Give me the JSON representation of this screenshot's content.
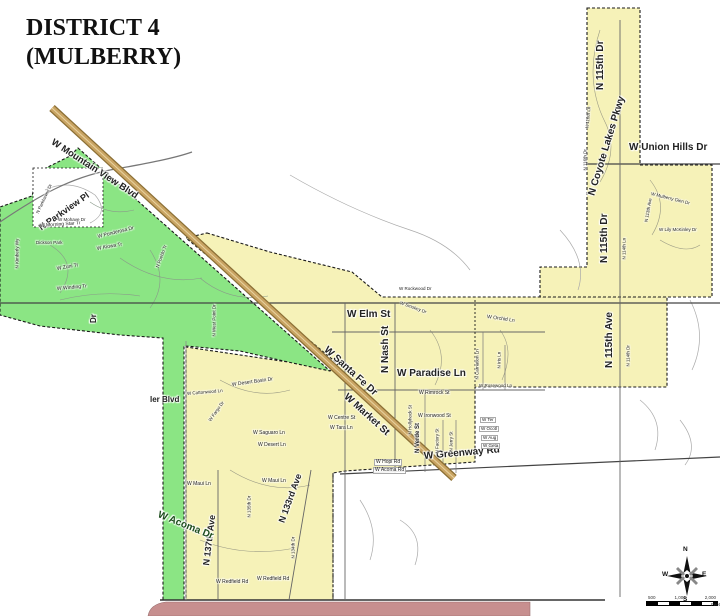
{
  "title": {
    "line1": "DISTRICT 4",
    "line2": "(MULBERRY)"
  },
  "colors": {
    "district_fill": "#F6F2B8",
    "district_green": "#8BE584",
    "adjacent_district_pink": "#C78F8F",
    "highway_tan": "#C9A463",
    "highway_edge": "#8B6F35",
    "boundary": "#1a1a1a",
    "road_gray": "#777777"
  },
  "compass": {
    "n": "N",
    "e": "E",
    "s": "S",
    "w": "W"
  },
  "scale": {
    "t1": "500",
    "t2": "1,000",
    "t3": "2,000",
    "unit": "Feet"
  },
  "labels": [
    {
      "t": "W Mountain View Blvd",
      "x": 52,
      "y": 146,
      "r": 33,
      "s": 9.5,
      "b": 1
    },
    {
      "t": "N Parkview Pl",
      "x": 40,
      "y": 233,
      "r": -35,
      "s": 9,
      "b": 1
    },
    {
      "t": "W Morning Star Tr",
      "x": 40,
      "y": 229,
      "r": -4,
      "s": 5
    },
    {
      "t": "Dickson Park",
      "x": 36,
      "y": 245,
      "s": 4.5
    },
    {
      "t": "W Ponderosa Dr",
      "x": 98,
      "y": 240,
      "r": -14,
      "s": 5
    },
    {
      "t": "W Kiowa Tr",
      "x": 97,
      "y": 252,
      "r": -10,
      "s": 5
    },
    {
      "t": "W Zuni Tr",
      "x": 57,
      "y": 272,
      "r": -10,
      "s": 5
    },
    {
      "t": "W Winding Tr",
      "x": 57,
      "y": 292,
      "r": -5,
      "s": 5
    },
    {
      "t": "N Kimberly Wy",
      "x": 20,
      "y": 268,
      "r": -90,
      "s": 4.5,
      "v": 1
    },
    {
      "t": "N Pueblo Tr",
      "x": 160,
      "y": 268,
      "r": -70,
      "s": 4.5,
      "v": 1
    },
    {
      "t": "W Mohave Dr",
      "x": 58,
      "y": 222,
      "s": 4.5
    },
    {
      "t": "N Parkhaven Dr",
      "x": 40,
      "y": 214,
      "r": -65,
      "s": 4.5,
      "v": 1
    },
    {
      "t": "Dr",
      "x": 98,
      "y": 323,
      "r": -90,
      "s": 8,
      "b": 1,
      "v": 1
    },
    {
      "t": "N West Point Dr",
      "x": 217,
      "y": 336,
      "r": -90,
      "s": 4.5,
      "v": 1
    },
    {
      "t": "ler Blvd",
      "x": 150,
      "y": 404,
      "s": 8,
      "b": 1
    },
    {
      "t": "W Santa Fe Dr",
      "x": 325,
      "y": 354,
      "r": 42,
      "s": 10,
      "b": 1
    },
    {
      "t": "W Market St",
      "x": 345,
      "y": 401,
      "r": 42,
      "s": 10,
      "b": 1
    },
    {
      "t": "W Elm St",
      "x": 347,
      "y": 320,
      "s": 10,
      "b": 1
    },
    {
      "t": "N Nash St",
      "x": 391,
      "y": 373,
      "r": -90,
      "s": 10,
      "b": 1,
      "v": 1
    },
    {
      "t": "W Paradise Ln",
      "x": 397,
      "y": 379,
      "s": 10,
      "b": 1
    },
    {
      "t": "W Greenway Rd",
      "x": 424,
      "y": 462,
      "r": -5,
      "s": 10,
      "b": 1
    },
    {
      "t": "W Union Hills Dr",
      "x": 629,
      "y": 153,
      "s": 10,
      "b": 1
    },
    {
      "t": "N 115th Dr",
      "x": 606,
      "y": 90,
      "r": -90,
      "s": 10,
      "b": 1,
      "v": 1
    },
    {
      "t": "N Coyote Lakes Pkwy",
      "x": 597,
      "y": 197,
      "r": -73,
      "s": 10,
      "b": 1,
      "v": 1
    },
    {
      "t": "N 115th Dr",
      "x": 610,
      "y": 263,
      "r": -90,
      "s": 10,
      "b": 1,
      "v": 1
    },
    {
      "t": "N 115th Ave",
      "x": 615,
      "y": 368,
      "r": -90,
      "s": 10,
      "b": 1,
      "v": 1
    },
    {
      "t": "N 137th Ave",
      "x": 211,
      "y": 566,
      "r": -83,
      "s": 9,
      "b": 1,
      "v": 1
    },
    {
      "t": "N 133rd Ave",
      "x": 286,
      "y": 524,
      "r": -70,
      "s": 9,
      "b": 1,
      "v": 1
    },
    {
      "t": "W Acoma Dr",
      "x": 158,
      "y": 520,
      "r": 22,
      "s": 10,
      "b": 1,
      "c": "#1d4d1d"
    },
    {
      "t": "W Rockwood Dr",
      "x": 399,
      "y": 291,
      "s": 4.5
    },
    {
      "t": "W Smokey Dr",
      "x": 400,
      "y": 305,
      "r": 20,
      "s": 4.5
    },
    {
      "t": "W Rimrock St",
      "x": 419,
      "y": 396,
      "s": 5
    },
    {
      "t": "W Ironwood St",
      "x": 418,
      "y": 419,
      "s": 5
    },
    {
      "t": "N Hollyhock St",
      "x": 413,
      "y": 434,
      "r": -90,
      "s": 4.5,
      "v": 1
    },
    {
      "t": "N Verde St",
      "x": 421,
      "y": 453,
      "r": -90,
      "s": 6,
      "b": 1,
      "v": 1
    },
    {
      "t": "N Factory St",
      "x": 440,
      "y": 453,
      "r": -90,
      "s": 4.5,
      "v": 1
    },
    {
      "t": "N Jerry St",
      "x": 454,
      "y": 451,
      "r": -90,
      "s": 4.5,
      "v": 1
    },
    {
      "t": "W Centre St",
      "x": 328,
      "y": 421,
      "s": 5
    },
    {
      "t": "W Tara Ln",
      "x": 330,
      "y": 431,
      "s": 5
    },
    {
      "t": "W Saguaro Ln",
      "x": 253,
      "y": 436,
      "s": 5
    },
    {
      "t": "W Desert Ln",
      "x": 258,
      "y": 448,
      "s": 5
    },
    {
      "t": "W Desert Basin Dr",
      "x": 232,
      "y": 388,
      "r": -8,
      "s": 5
    },
    {
      "t": "W Fargo Dr",
      "x": 212,
      "y": 422,
      "r": -55,
      "s": 4.5,
      "v": 1
    },
    {
      "t": "W Cottonwood Ln",
      "x": 187,
      "y": 396,
      "r": -5,
      "s": 4.5
    },
    {
      "t": "W Orchid Ln",
      "x": 487,
      "y": 320,
      "r": 8,
      "s": 5
    },
    {
      "t": "N Carnation Ln",
      "x": 480,
      "y": 379,
      "r": -90,
      "s": 4.5,
      "v": 1
    },
    {
      "t": "N Iris Ln",
      "x": 502,
      "y": 368,
      "r": -90,
      "s": 4.5,
      "v": 1
    },
    {
      "t": "W Rosewood Ln",
      "x": 479,
      "y": 388,
      "s": 4.5
    },
    {
      "t": "W Hopi Rd",
      "x": 374,
      "y": 464,
      "s": 5,
      "box": 1
    },
    {
      "t": "W Acoma Rd",
      "x": 373,
      "y": 472,
      "s": 5,
      "box": 1
    },
    {
      "t": "W Maui Ln",
      "x": 187,
      "y": 487,
      "s": 5
    },
    {
      "t": "W Maui Ln",
      "x": 262,
      "y": 484,
      "s": 5
    },
    {
      "t": "W Redfield Rd",
      "x": 216,
      "y": 585,
      "s": 5
    },
    {
      "t": "W Redfield Rd",
      "x": 257,
      "y": 582,
      "s": 5
    },
    {
      "t": "N 135th Dr",
      "x": 252,
      "y": 517,
      "r": -90,
      "s": 4.5,
      "v": 1
    },
    {
      "t": "N 134th Dr",
      "x": 296,
      "y": 558,
      "r": -90,
      "s": 4.5,
      "v": 1
    },
    {
      "t": "N 116th Ln",
      "x": 590,
      "y": 128,
      "r": -85,
      "s": 4.5,
      "v": 1
    },
    {
      "t": "N 116th Dr",
      "x": 588,
      "y": 170,
      "r": -90,
      "s": 4.5,
      "v": 1
    },
    {
      "t": "W Mulberry Glen Dr",
      "x": 651,
      "y": 196,
      "r": 14,
      "s": 4.5
    },
    {
      "t": "N 113th Ave",
      "x": 649,
      "y": 222,
      "r": -80,
      "s": 4.5,
      "v": 1
    },
    {
      "t": "W Lily McKinley Dr",
      "x": 659,
      "y": 232,
      "s": 4.5
    },
    {
      "t": "N 114th Ln",
      "x": 627,
      "y": 259,
      "r": -90,
      "s": 4.5,
      "v": 1
    },
    {
      "t": "N 114th Dr",
      "x": 631,
      "y": 366,
      "r": -90,
      "s": 4.5,
      "v": 1
    },
    {
      "t": "W Ter",
      "x": 480,
      "y": 421,
      "s": 4.5,
      "box": 1
    },
    {
      "t": "W Ocotl",
      "x": 479,
      "y": 430,
      "s": 4.5,
      "box": 1
    },
    {
      "t": "W Aug",
      "x": 481,
      "y": 439,
      "s": 4.5,
      "box": 1
    },
    {
      "t": "W Geta",
      "x": 481,
      "y": 447,
      "s": 4.5,
      "box": 1
    }
  ]
}
